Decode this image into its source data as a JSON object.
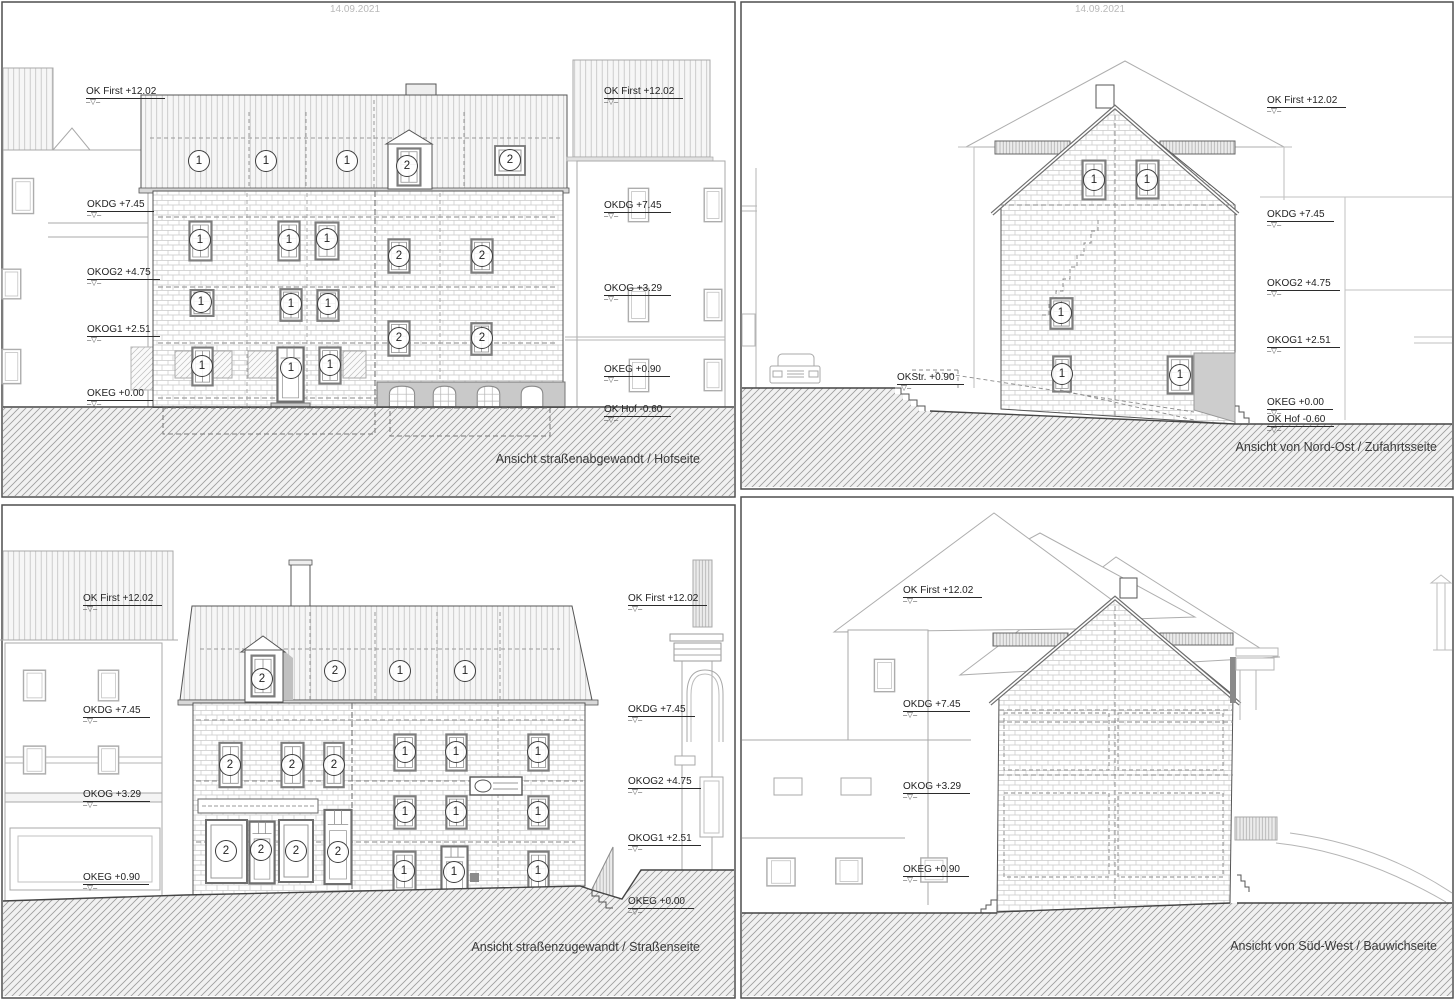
{
  "meta": {
    "date_left": "14.09.2021",
    "date_right": "14.09.2021",
    "marker_symbol": "–▽–"
  },
  "panels": [
    {
      "id": "hofseite",
      "caption": "Ansicht straßenabgewandt / Hofseite",
      "markers": [
        {
          "label": "OK First +12.02",
          "x": 86,
          "y": 82
        },
        {
          "label": "OKDG +7.45",
          "x": 87,
          "y": 195
        },
        {
          "label": "OKOG2 +4.75",
          "x": 87,
          "y": 263
        },
        {
          "label": "OKOG1 +2.51",
          "x": 87,
          "y": 320
        },
        {
          "label": "OKEG +0.00",
          "x": 87,
          "y": 384
        },
        {
          "label": "OK First +12.02",
          "x": 604,
          "y": 82
        },
        {
          "label": "OKDG +7.45",
          "x": 604,
          "y": 196
        },
        {
          "label": "OKOG +3.29",
          "x": 604,
          "y": 279
        },
        {
          "label": "OKEG +0.90",
          "x": 604,
          "y": 360
        },
        {
          "label": "OK Hof -0.60",
          "x": 604,
          "y": 400
        }
      ],
      "badges": [
        {
          "n": "1",
          "x": 199,
          "y": 161
        },
        {
          "n": "1",
          "x": 266,
          "y": 161
        },
        {
          "n": "1",
          "x": 347,
          "y": 161
        },
        {
          "n": "2",
          "x": 407,
          "y": 166
        },
        {
          "n": "2",
          "x": 510,
          "y": 160
        },
        {
          "n": "1",
          "x": 200,
          "y": 240
        },
        {
          "n": "1",
          "x": 289,
          "y": 240
        },
        {
          "n": "1",
          "x": 327,
          "y": 239
        },
        {
          "n": "1",
          "x": 201,
          "y": 302
        },
        {
          "n": "1",
          "x": 291,
          "y": 304
        },
        {
          "n": "1",
          "x": 328,
          "y": 304
        },
        {
          "n": "1",
          "x": 202,
          "y": 366
        },
        {
          "n": "1",
          "x": 291,
          "y": 368
        },
        {
          "n": "1",
          "x": 330,
          "y": 365
        },
        {
          "n": "2",
          "x": 399,
          "y": 256
        },
        {
          "n": "2",
          "x": 482,
          "y": 256
        },
        {
          "n": "2",
          "x": 399,
          "y": 338
        },
        {
          "n": "2",
          "x": 482,
          "y": 338
        }
      ]
    },
    {
      "id": "zufahrtsseite",
      "caption": "Ansicht von Nord-Ost / Zufahrtsseite",
      "markers": [
        {
          "label": "OK First +12.02",
          "x": 1267,
          "y": 91
        },
        {
          "label": "OKDG +7.45",
          "x": 1267,
          "y": 205
        },
        {
          "label": "OKOG2 +4.75",
          "x": 1267,
          "y": 274
        },
        {
          "label": "OKOG1 +2.51",
          "x": 1267,
          "y": 331
        },
        {
          "label": "OKEG +0.00",
          "x": 1267,
          "y": 393
        },
        {
          "label": "OK Hof -0.60",
          "x": 1267,
          "y": 410
        },
        {
          "label": "OKStr. +0.90",
          "x": 897,
          "y": 368
        }
      ],
      "badges": [
        {
          "n": "1",
          "x": 1094,
          "y": 180
        },
        {
          "n": "1",
          "x": 1147,
          "y": 180
        },
        {
          "n": "1",
          "x": 1061,
          "y": 313
        },
        {
          "n": "1",
          "x": 1062,
          "y": 374
        },
        {
          "n": "1",
          "x": 1180,
          "y": 375
        }
      ]
    },
    {
      "id": "strassenseite",
      "caption": "Ansicht straßenzugewandt / Straßenseite",
      "markers": [
        {
          "label": "OK First +12.02",
          "x": 83,
          "y": 589
        },
        {
          "label": "OKDG +7.45",
          "x": 83,
          "y": 701
        },
        {
          "label": "OKOG +3.29",
          "x": 83,
          "y": 785
        },
        {
          "label": "OKEG +0.90",
          "x": 83,
          "y": 868
        },
        {
          "label": "OK First +12.02",
          "x": 628,
          "y": 589
        },
        {
          "label": "OKDG +7.45",
          "x": 628,
          "y": 700
        },
        {
          "label": "OKOG2 +4.75",
          "x": 628,
          "y": 772
        },
        {
          "label": "OKOG1 +2.51",
          "x": 628,
          "y": 829
        },
        {
          "label": "OKEG +0.00",
          "x": 628,
          "y": 892
        }
      ],
      "badges": [
        {
          "n": "2",
          "x": 262,
          "y": 679
        },
        {
          "n": "2",
          "x": 335,
          "y": 671
        },
        {
          "n": "1",
          "x": 400,
          "y": 671
        },
        {
          "n": "1",
          "x": 465,
          "y": 671
        },
        {
          "n": "2",
          "x": 230,
          "y": 765
        },
        {
          "n": "2",
          "x": 292,
          "y": 765
        },
        {
          "n": "2",
          "x": 334,
          "y": 765
        },
        {
          "n": "2",
          "x": 226,
          "y": 851
        },
        {
          "n": "2",
          "x": 261,
          "y": 850
        },
        {
          "n": "2",
          "x": 296,
          "y": 851
        },
        {
          "n": "2",
          "x": 338,
          "y": 852
        },
        {
          "n": "1",
          "x": 405,
          "y": 752
        },
        {
          "n": "1",
          "x": 456,
          "y": 752
        },
        {
          "n": "1",
          "x": 538,
          "y": 752
        },
        {
          "n": "1",
          "x": 405,
          "y": 812
        },
        {
          "n": "1",
          "x": 456,
          "y": 812
        },
        {
          "n": "1",
          "x": 538,
          "y": 812
        },
        {
          "n": "1",
          "x": 404,
          "y": 871
        },
        {
          "n": "1",
          "x": 454,
          "y": 872
        },
        {
          "n": "1",
          "x": 538,
          "y": 871
        }
      ]
    },
    {
      "id": "bauwichseite",
      "caption": "Ansicht von Süd-West / Bauwichseite",
      "markers": [
        {
          "label": "OK First +12.02",
          "x": 903,
          "y": 581
        },
        {
          "label": "OKDG +7.45",
          "x": 903,
          "y": 695
        },
        {
          "label": "OKOG +3.29",
          "x": 903,
          "y": 777
        },
        {
          "label": "OKEG +0.90",
          "x": 903,
          "y": 860
        }
      ],
      "badges": []
    }
  ]
}
